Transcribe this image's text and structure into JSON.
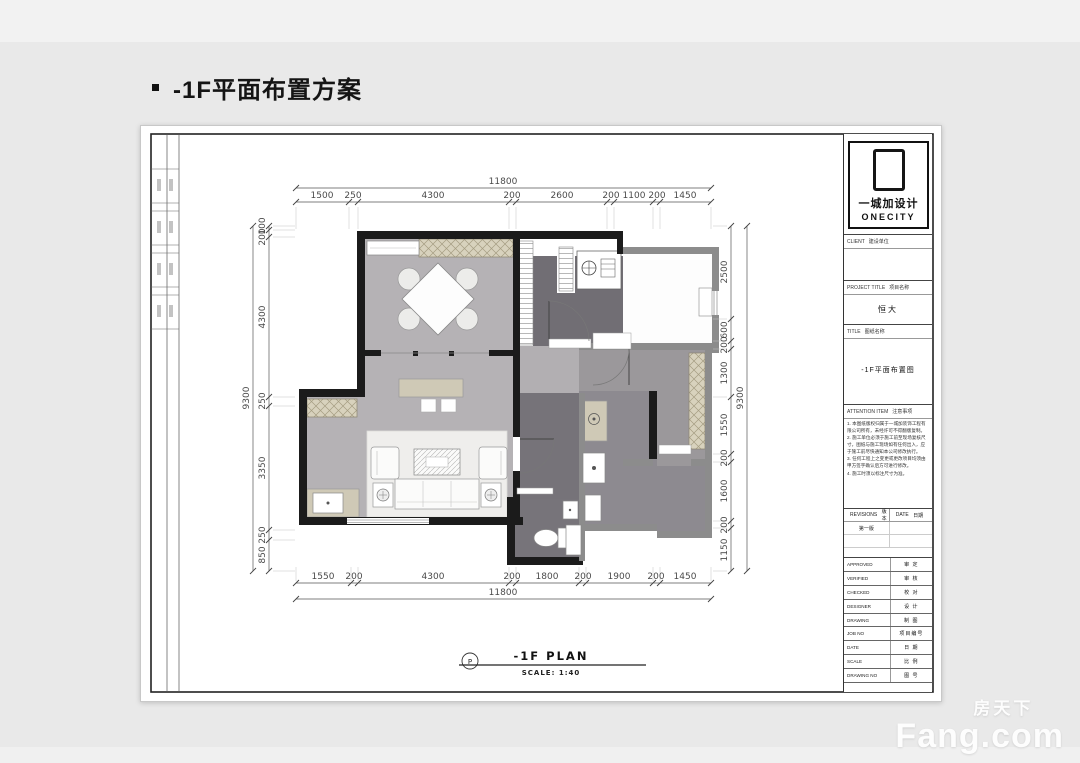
{
  "page": {
    "heading": "-1F平面布置方案"
  },
  "logo": {
    "brand_cn": "一城加设计",
    "brand_en": "ONECITY"
  },
  "titleblock": {
    "client_label": "CLIENT",
    "client_cn": "建设单位",
    "project_label": "PROJECT TITLE",
    "project_cn": "项目名称",
    "project_value": "恒大",
    "title_label": "TITLE",
    "title_cn": "图纸名称",
    "title_value": "-1F平面布置图",
    "attention_label": "ATTENTION ITEM",
    "attention_cn": "注意事项",
    "notes": [
      "1. 本图纸版权归属于一城加装饰工程有限公司所有，未经许可不得翻版复制。",
      "2. 施工单位必须于施工前至现场复核尺寸，图纸与施工现场如有任何出入，应于施工前尽快通知本公司修改执行。",
      "3. 任何工程上之变更或更改项目均须由甲方签字确认后方可进行修改。",
      "4. 施工时须以标注尺寸为准。"
    ],
    "revisions_label": "REVISIONS",
    "revisions_cn": "版本",
    "date_label": "DATE",
    "date_cn": "日期",
    "revision_value": "第一版",
    "rows": [
      {
        "en": "APPROVED",
        "cn": "审 定"
      },
      {
        "en": "VERIFIED",
        "cn": "审 核"
      },
      {
        "en": "CHECKED",
        "cn": "校 对"
      },
      {
        "en": "DESIGNER",
        "cn": "设 计"
      },
      {
        "en": "DRAWING",
        "cn": "制 图"
      },
      {
        "en": "JOB NO",
        "cn": "项目编号"
      },
      {
        "en": "DATE",
        "cn": "日 期"
      },
      {
        "en": "SCALE",
        "cn": "比 例"
      },
      {
        "en": "DRAWING NO",
        "cn": "图 号"
      }
    ]
  },
  "plan_label": {
    "bubble": "P",
    "title": "-1F PLAN",
    "scale": "SCALE: 1:40"
  },
  "dimensions": {
    "top": {
      "overall": "11800",
      "segments": [
        "1500",
        "250",
        "4300",
        "200",
        "2600",
        "200",
        "1100",
        "200",
        "1450"
      ]
    },
    "bottom": {
      "overall": "11800",
      "segments": [
        "1550",
        "200",
        "4300",
        "200",
        "1800",
        "200",
        "1900",
        "200",
        "1450"
      ]
    },
    "left": {
      "overall": "9300",
      "segments": [
        "100",
        "200",
        "4300",
        "250",
        "3350",
        "250",
        "850"
      ]
    },
    "right": {
      "overall": "9300",
      "segments": [
        "2500",
        "600",
        "200",
        "1300",
        "1550",
        "200",
        "1600",
        "200",
        "1150"
      ]
    }
  },
  "watermark": {
    "line1": "房天下",
    "line2": "Fang.com"
  },
  "colors": {
    "background": "#e9e9e9",
    "wall": "#1b1b1b",
    "wall_gray": "#8c8c8c",
    "floor_light": "#b5b2b5",
    "floor_medium": "#9b989b",
    "floor_dark": "#716e74",
    "cabinet_tan": "#d8d2bd",
    "sheet": "#ffffff"
  }
}
